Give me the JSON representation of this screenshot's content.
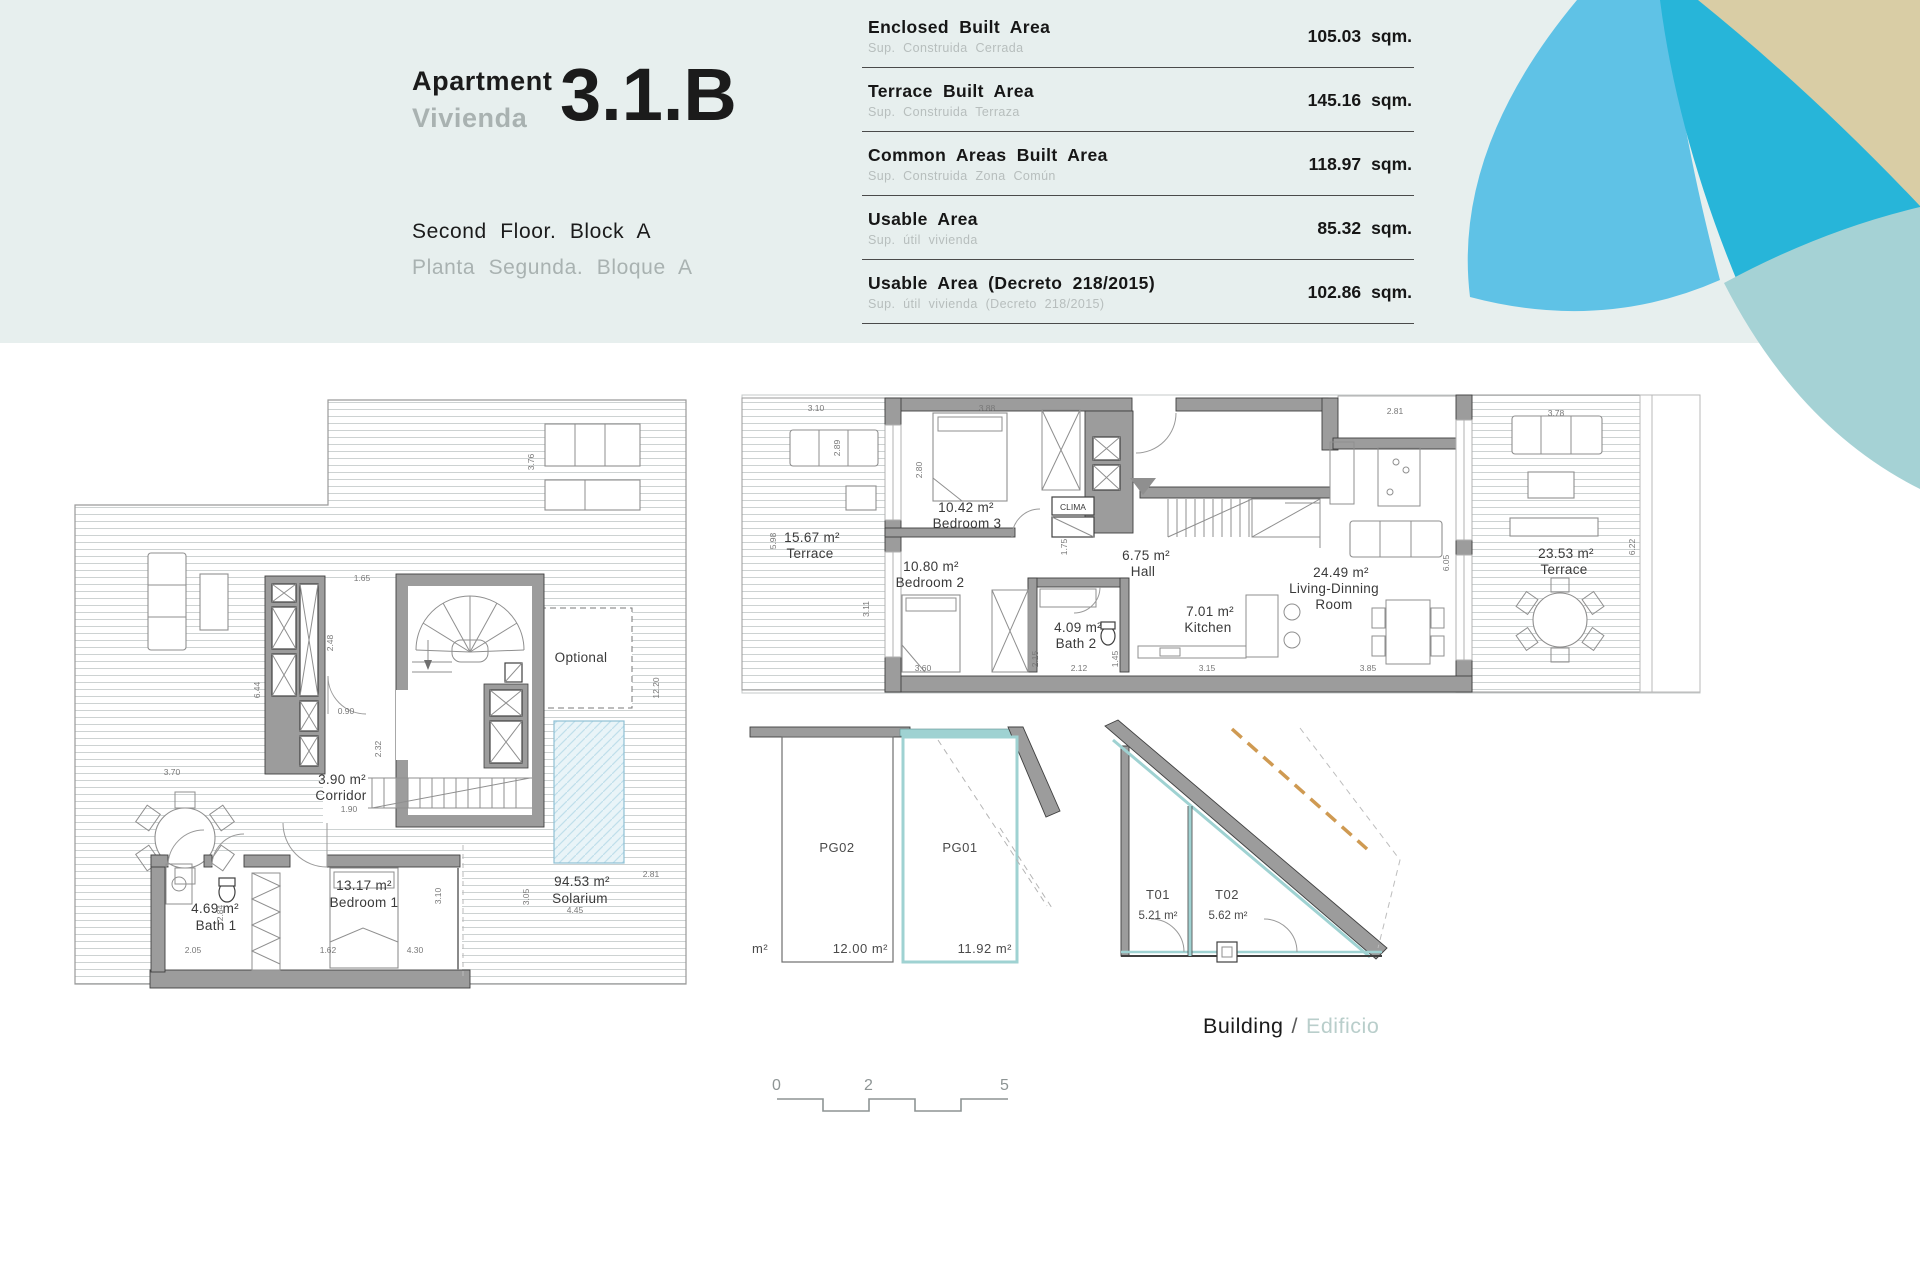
{
  "header": {
    "apartment_en": "Apartment",
    "apartment_es": "Vivienda",
    "unit": "3.1.B",
    "floor_en": "Second Floor. Block A",
    "floor_es": "Planta Segunda. Bloque A"
  },
  "area_table": {
    "rows": [
      {
        "label_en": "Enclosed Built Area",
        "label_es": "Sup. Construida Cerrada",
        "value": "105.03",
        "unit": "sqm."
      },
      {
        "label_en": "Terrace Built Area",
        "label_es": "Sup. Construida Terraza",
        "value": "145.16",
        "unit": "sqm."
      },
      {
        "label_en": "Common Areas Built Area",
        "label_es": "Sup. Construida Zona Común",
        "value": "118.97",
        "unit": "sqm."
      },
      {
        "label_en": "Usable Area",
        "label_es": "Sup. útil vivienda",
        "value": "85.32",
        "unit": "sqm."
      },
      {
        "label_en": "Usable Area (Decreto 218/2015)",
        "label_es": "Sup. útil vivienda (Decreto 218/2015)",
        "value": "102.86",
        "unit": "sqm."
      }
    ]
  },
  "main_plan": {
    "rooms": {
      "terrace_left": {
        "area": "15.67 m²",
        "name": "Terrace"
      },
      "bedroom3": {
        "area": "10.42 m²",
        "name": "Bedroom 3"
      },
      "bedroom2": {
        "area": "10.80 m²",
        "name": "Bedroom 2"
      },
      "hall": {
        "area": "6.75 m²",
        "name": "Hall"
      },
      "bath2": {
        "area": "4.09 m²",
        "name": "Bath 2"
      },
      "kitchen": {
        "area": "7.01 m²",
        "name": "Kitchen"
      },
      "living": {
        "area": "24.49 m²",
        "name_1": "Living-Dinning",
        "name_2": "Room"
      },
      "terrace_right": {
        "area": "23.53 m²",
        "name": "Terrace"
      },
      "clima": "CLIMA"
    },
    "dims": [
      "3.10",
      "3.88",
      "2.80",
      "2.89",
      "5.98",
      "3.11",
      "3.60",
      "2.15",
      "2.12",
      "1.45",
      "1.75",
      "2.81",
      "3.15",
      "3.85",
      "6.05",
      "3.78",
      "6.22"
    ]
  },
  "solarium_plan": {
    "rooms": {
      "corridor": {
        "area": "3.90 m²",
        "name": "Corridor"
      },
      "bedroom1": {
        "area": "13.17 m²",
        "name": "Bedroom 1"
      },
      "bath1": {
        "area": "4.69 m²",
        "name": "Bath 1"
      },
      "solarium": {
        "area": "94.53 m²",
        "name": "Solarium"
      },
      "optional": "Optional"
    },
    "dims": [
      "1.65",
      "2.48",
      "6.44",
      "0.90",
      "2.32",
      "1.90",
      "3.70",
      "3.76",
      "12.20",
      "2.05",
      "2.84",
      "1.62",
      "3.10",
      "4.30",
      "3.05",
      "4.45",
      "2.81"
    ]
  },
  "parking": {
    "pg02": {
      "name": "PG02",
      "area": "12.00 m²"
    },
    "pg01": {
      "name": "PG01",
      "area": "11.92 m²"
    },
    "partial_unit": "m²"
  },
  "storage": {
    "t01": {
      "name": "T01",
      "area": "5.21 m²"
    },
    "t02": {
      "name": "T02",
      "area": "5.62 m²"
    }
  },
  "building_label": {
    "en": "Building",
    "sep": "/",
    "es": "Edificio"
  },
  "scale_bar": {
    "ticks": [
      "0",
      "2",
      "5"
    ]
  },
  "colors": {
    "band": "#e7efee",
    "petal_light_blue": "#5fc2e6",
    "petal_dark_teal": "#27b5d9",
    "petal_beige": "#d9cda5",
    "petal_muted_teal": "#a5d2d5",
    "highlight_teal": "#9fd2d2",
    "dashed_orange": "#cf9a52",
    "wall_gray": "#9c9c9c"
  }
}
